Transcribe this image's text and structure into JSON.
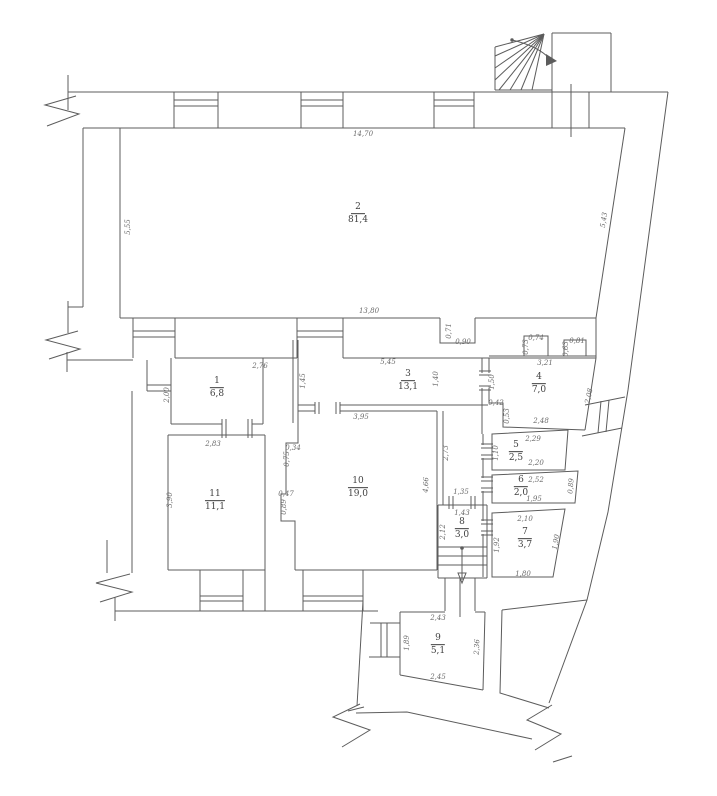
{
  "drawing": {
    "kind": "apartment floor plan",
    "colors": {
      "wall_line": "#5c5c5c",
      "room_text": "#3f3f3f",
      "dim_text": "#6a6a6a",
      "background": "#ffffff"
    }
  },
  "rooms": [
    {
      "number": "2",
      "area": "81,4",
      "x": 358,
      "y": 214
    },
    {
      "number": "1",
      "area": "6,8",
      "x": 217,
      "y": 388
    },
    {
      "number": "3",
      "area": "13,1",
      "x": 408,
      "y": 381
    },
    {
      "number": "4",
      "area": "7,0",
      "x": 539,
      "y": 384
    },
    {
      "number": "5",
      "area": "2,5",
      "x": 516,
      "y": 452
    },
    {
      "number": "6",
      "area": "2,0",
      "x": 521,
      "y": 487
    },
    {
      "number": "7",
      "area": "3,7",
      "x": 525,
      "y": 539
    },
    {
      "number": "8",
      "area": "3,0",
      "x": 462,
      "y": 529
    },
    {
      "number": "9",
      "area": "5,1",
      "x": 438,
      "y": 645
    },
    {
      "number": "10",
      "area": "19,0",
      "x": 358,
      "y": 488
    },
    {
      "number": "11",
      "area": "11,1",
      "x": 215,
      "y": 501
    }
  ],
  "dimensions": [
    {
      "text": "14,70",
      "x": 363,
      "y": 134,
      "r": 0
    },
    {
      "text": "5,55",
      "x": 128,
      "y": 227,
      "r": -90
    },
    {
      "text": "5,43",
      "x": 604,
      "y": 220,
      "r": -81
    },
    {
      "text": "13,80",
      "x": 369,
      "y": 311,
      "r": 0
    },
    {
      "text": "0,71",
      "x": 449,
      "y": 331,
      "r": -90
    },
    {
      "text": "0,90",
      "x": 463,
      "y": 342,
      "r": 0
    },
    {
      "text": "2,76",
      "x": 260,
      "y": 366,
      "r": 0
    },
    {
      "text": "2,00",
      "x": 167,
      "y": 395,
      "r": -90
    },
    {
      "text": "5,45",
      "x": 388,
      "y": 362,
      "r": 0
    },
    {
      "text": "1,45",
      "x": 303,
      "y": 381,
      "r": -90
    },
    {
      "text": "1,40",
      "x": 436,
      "y": 379,
      "r": -90
    },
    {
      "text": "3,21",
      "x": 545,
      "y": 363,
      "r": 0
    },
    {
      "text": "0,74",
      "x": 536,
      "y": 338,
      "r": 0
    },
    {
      "text": "0,73",
      "x": 526,
      "y": 347,
      "r": -90
    },
    {
      "text": "0,81",
      "x": 577,
      "y": 341,
      "r": 0
    },
    {
      "text": "0,63",
      "x": 566,
      "y": 349,
      "r": -90
    },
    {
      "text": "1,50",
      "x": 492,
      "y": 382,
      "r": -90
    },
    {
      "text": "0,42",
      "x": 496,
      "y": 403,
      "r": 0
    },
    {
      "text": "0,53",
      "x": 507,
      "y": 416,
      "r": -90
    },
    {
      "text": "2,48",
      "x": 541,
      "y": 421,
      "r": 0
    },
    {
      "text": "2,08",
      "x": 589,
      "y": 396,
      "r": -78
    },
    {
      "text": "2,29",
      "x": 533,
      "y": 439,
      "r": 0
    },
    {
      "text": "2,20",
      "x": 536,
      "y": 463,
      "r": 0
    },
    {
      "text": "1,10",
      "x": 496,
      "y": 453,
      "r": -90
    },
    {
      "text": "2,52",
      "x": 536,
      "y": 480,
      "r": 0
    },
    {
      "text": "1,95",
      "x": 534,
      "y": 499,
      "r": 0
    },
    {
      "text": "0,89",
      "x": 571,
      "y": 486,
      "r": -85
    },
    {
      "text": "2,10",
      "x": 525,
      "y": 519,
      "r": 0
    },
    {
      "text": "1,80",
      "x": 523,
      "y": 574,
      "r": 0
    },
    {
      "text": "1,90",
      "x": 556,
      "y": 542,
      "r": -80
    },
    {
      "text": "1,92",
      "x": 497,
      "y": 545,
      "r": -90
    },
    {
      "text": "1,43",
      "x": 462,
      "y": 513,
      "r": 0
    },
    {
      "text": "2,12",
      "x": 443,
      "y": 532,
      "r": -90
    },
    {
      "text": "1,35",
      "x": 461,
      "y": 492,
      "r": 0
    },
    {
      "text": "2,73",
      "x": 446,
      "y": 453,
      "r": -90
    },
    {
      "text": "3,95",
      "x": 361,
      "y": 417,
      "r": 0
    },
    {
      "text": "4,66",
      "x": 426,
      "y": 485,
      "r": -87
    },
    {
      "text": "0,34",
      "x": 293,
      "y": 448,
      "r": 0
    },
    {
      "text": "0,75",
      "x": 287,
      "y": 459,
      "r": -90
    },
    {
      "text": "0,47",
      "x": 286,
      "y": 494,
      "r": 0
    },
    {
      "text": "0,89",
      "x": 284,
      "y": 507,
      "r": -90
    },
    {
      "text": "2,83",
      "x": 213,
      "y": 444,
      "r": 0
    },
    {
      "text": "3,90",
      "x": 170,
      "y": 500,
      "r": -90
    },
    {
      "text": "2,43",
      "x": 438,
      "y": 618,
      "r": 0
    },
    {
      "text": "2,45",
      "x": 438,
      "y": 677,
      "r": 0
    },
    {
      "text": "1,89",
      "x": 407,
      "y": 643,
      "r": -90
    },
    {
      "text": "2,36",
      "x": 477,
      "y": 647,
      "r": -87
    }
  ]
}
